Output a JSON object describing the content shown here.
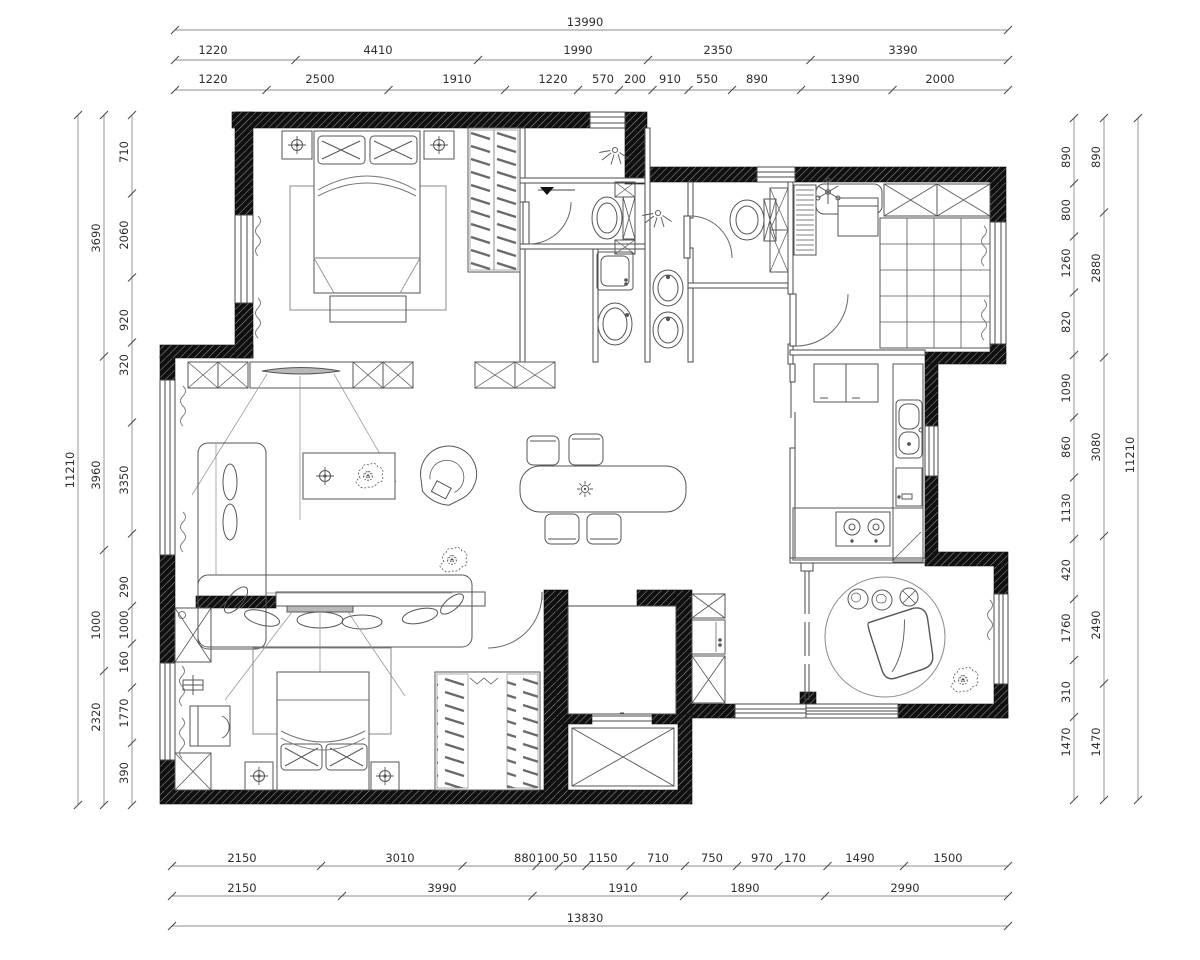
{
  "meta": {
    "drawing_type": "architectural-floor-plan",
    "background": "#ffffff",
    "wall_fill": "#101010",
    "wall_hatch_line": "#9a9a9a",
    "outline_color": "#4a4a4a",
    "furniture_color": "#5a5a5a",
    "dim_line_color": "#8c8c8c",
    "dim_text_color": "#2e2e2e"
  },
  "icons": {
    "ceiling_light": "circle-with-cross",
    "chandelier_fan": "six-spoke-asterisk",
    "pendant_light": "rayed-circle",
    "shower_head": "circle-with-spray-rays",
    "floor_drain": "black-triangle",
    "plant": "scribble-blob",
    "elevator": "rectangle-with-x",
    "cabinet": "box-with-x"
  },
  "dimensions": {
    "top": {
      "x1": 175,
      "x2": 1008,
      "rows": [
        {
          "text_y": 22,
          "line_y": 30,
          "labels": [
            {
              "t": "13990",
              "x": 585
            }
          ]
        },
        {
          "text_y": 50,
          "line_y": 60,
          "labels": [
            {
              "t": "1220",
              "x": 213
            },
            {
              "t": "4410",
              "x": 378
            },
            {
              "t": "1990",
              "x": 578
            },
            {
              "t": "2350",
              "x": 718
            },
            {
              "t": "3390",
              "x": 903
            }
          ]
        },
        {
          "text_y": 79,
          "line_y": 90,
          "labels": [
            {
              "t": "1220",
              "x": 213
            },
            {
              "t": "2500",
              "x": 320
            },
            {
              "t": "1910",
              "x": 457
            },
            {
              "t": "1220",
              "x": 553
            },
            {
              "t": "570",
              "x": 603
            },
            {
              "t": "200",
              "x": 635
            },
            {
              "t": "910",
              "x": 670
            },
            {
              "t": "550",
              "x": 707
            },
            {
              "t": "890",
              "x": 757
            },
            {
              "t": "1390",
              "x": 845
            },
            {
              "t": "2000",
              "x": 940
            }
          ]
        }
      ]
    },
    "bottom": {
      "x1": 172,
      "x2": 1008,
      "rows": [
        {
          "text_y": 858,
          "line_y": 866,
          "labels": [
            {
              "t": "2150",
              "x": 242
            },
            {
              "t": "3010",
              "x": 400
            },
            {
              "t": "880",
              "x": 525
            },
            {
              "t": "100",
              "x": 548
            },
            {
              "t": "50",
              "x": 570
            },
            {
              "t": "1150",
              "x": 603
            },
            {
              "t": "710",
              "x": 658
            },
            {
              "t": "750",
              "x": 712
            },
            {
              "t": "970",
              "x": 762
            },
            {
              "t": "170",
              "x": 795
            },
            {
              "t": "1490",
              "x": 860
            },
            {
              "t": "1500",
              "x": 948
            }
          ]
        },
        {
          "text_y": 888,
          "line_y": 896,
          "labels": [
            {
              "t": "2150",
              "x": 242
            },
            {
              "t": "3990",
              "x": 442
            },
            {
              "t": "1910",
              "x": 623
            },
            {
              "t": "1890",
              "x": 745
            },
            {
              "t": "2990",
              "x": 905
            }
          ]
        },
        {
          "text_y": 918,
          "line_y": 926,
          "labels": [
            {
              "t": "13830",
              "x": 585
            }
          ]
        }
      ]
    },
    "left": {
      "y1": 115,
      "y2": 805,
      "cols": [
        {
          "text_x": 70,
          "line_x": 78,
          "labels": [
            {
              "t": "11210",
              "y": 470
            }
          ]
        },
        {
          "text_x": 96,
          "line_x": 104,
          "labels": [
            {
              "t": "3690",
              "y": 238
            },
            {
              "t": "3960",
              "y": 475
            },
            {
              "t": "1000",
              "y": 625
            },
            {
              "t": "2320",
              "y": 717
            }
          ]
        },
        {
          "text_x": 124,
          "line_x": 132,
          "labels": [
            {
              "t": "710",
              "y": 152
            },
            {
              "t": "2060",
              "y": 235
            },
            {
              "t": "920",
              "y": 320
            },
            {
              "t": "320",
              "y": 365
            },
            {
              "t": "3350",
              "y": 480
            },
            {
              "t": "290",
              "y": 587
            },
            {
              "t": "1000",
              "y": 625
            },
            {
              "t": "160",
              "y": 662
            },
            {
              "t": "1770",
              "y": 713
            },
            {
              "t": "390",
              "y": 773
            }
          ]
        }
      ]
    },
    "right": {
      "y1": 118,
      "y2": 800,
      "cols": [
        {
          "text_x": 1066,
          "line_x": 1074,
          "labels": [
            {
              "t": "890",
              "y": 157
            },
            {
              "t": "800",
              "y": 210
            },
            {
              "t": "1260",
              "y": 263
            },
            {
              "t": "820",
              "y": 322
            },
            {
              "t": "1090",
              "y": 388
            },
            {
              "t": "860",
              "y": 447
            },
            {
              "t": "1130",
              "y": 508
            },
            {
              "t": "420",
              "y": 570
            },
            {
              "t": "1760",
              "y": 628
            },
            {
              "t": "310",
              "y": 692
            },
            {
              "t": "1470",
              "y": 742
            }
          ]
        },
        {
          "text_x": 1096,
          "line_x": 1104,
          "labels": [
            {
              "t": "890",
              "y": 157
            },
            {
              "t": "2880",
              "y": 268
            },
            {
              "t": "3080",
              "y": 447
            },
            {
              "t": "2490",
              "y": 625
            },
            {
              "t": "1470",
              "y": 742
            }
          ]
        },
        {
          "text_x": 1130,
          "line_x": 1138,
          "labels": [
            {
              "t": "11210",
              "y": 455
            }
          ]
        }
      ]
    }
  }
}
